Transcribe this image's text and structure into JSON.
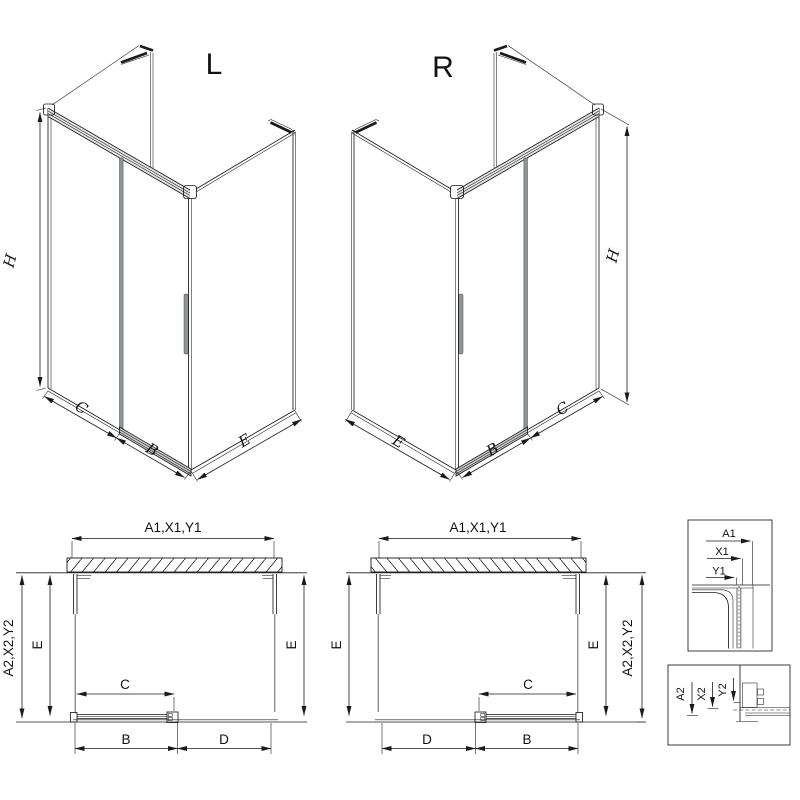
{
  "iso_left": {
    "letter": "L",
    "dim_height": "H",
    "dims_bottom": [
      "C",
      "B",
      "E"
    ]
  },
  "iso_right": {
    "letter": "R",
    "dim_height": "H",
    "dims_bottom": [
      "E",
      "B",
      "C"
    ]
  },
  "plan_left": {
    "dim_top": "A1,X1,Y1",
    "dim_left_outer": "A2,X2,Y2",
    "dim_left_inner": "E",
    "dim_right": "E",
    "dim_door": "C",
    "dim_bottom_left": "B",
    "dim_bottom_right": "D"
  },
  "plan_right": {
    "dim_top": "A1,X1,Y1",
    "dim_left": "E",
    "dim_right_inner": "E",
    "dim_right_outer": "A2,X2,Y2",
    "dim_door": "C",
    "dim_bottom_left": "D",
    "dim_bottom_right": "B"
  },
  "detail_top": {
    "labels": [
      "A1",
      "X1",
      "Y1"
    ]
  },
  "detail_bottom": {
    "labels": [
      "A2",
      "X2",
      "Y2"
    ]
  },
  "colors": {
    "line": "#1a1a1a",
    "glass": "#5f6366",
    "gray_fill": "#8f9497",
    "background": "#ffffff"
  }
}
